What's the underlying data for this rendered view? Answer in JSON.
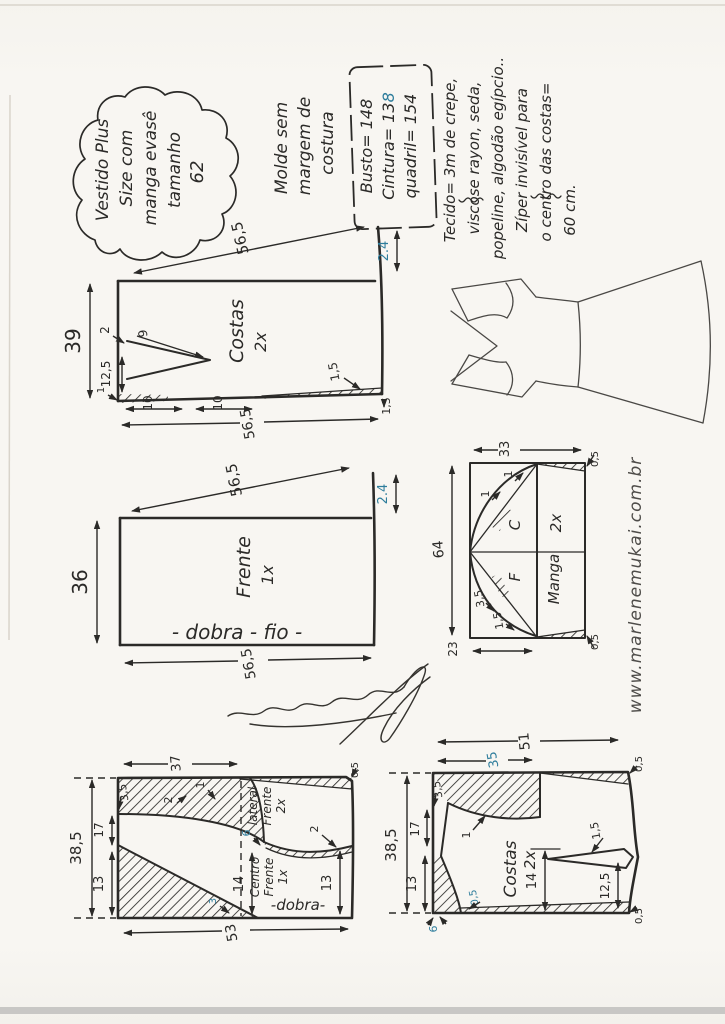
{
  "colors": {
    "ink": "#2b2a28",
    "blue": "#2e7d9c",
    "paper": "#f8f6f2"
  },
  "title_cloud": {
    "l1": "Vestido Plus",
    "l2": "Size com",
    "l3": "manga evasê",
    "l4": "tamanho",
    "l5": "62"
  },
  "molde_note": {
    "l1": "Molde sem",
    "l2": "margem de",
    "l3": "costura"
  },
  "measures": {
    "busto": "Busto= 148",
    "cintura_a": "Cintura= 13",
    "cintura_b": "8",
    "quadril": "quadril= 154"
  },
  "fabric": {
    "l1": "Tecido= 3m de crepe,",
    "l2": "viscose rayon, seda,",
    "l3": "popeline, algodão egípcio..",
    "l4": "Zíper invisível para",
    "l5": "o centro das costas=",
    "l6": "60 cm."
  },
  "watermark": "www.marlenemukai.com.br",
  "bodice_back": {
    "label": "Costas",
    "qty": "2x",
    "shoulder": "56,5",
    "neck_drop": "2.4",
    "length": "39",
    "dart_intake": "2",
    "dart_len": "9",
    "dart_pos": "12,5",
    "corner": "1",
    "seg1": "10",
    "seg2": "10",
    "hem": "56,5",
    "hem_curve": "1,5",
    "hem_corner": "1,5"
  },
  "bodice_front": {
    "label": "Frente",
    "qty": "1x",
    "shoulder": "56,5",
    "neck_drop": "2.4",
    "length": "36",
    "fold": "- dobra - fio -",
    "hem": "56,5"
  },
  "sleeve": {
    "label": "Manga",
    "qty": "2x",
    "top": "33",
    "width": "64",
    "bottom": "23",
    "back_letter": "C",
    "front_letter": "F",
    "n1": "1",
    "n2": "1",
    "n3": "3,5",
    "n4": "1,5",
    "c_top": "0,5",
    "c_bottom": "0,5"
  },
  "skirt_front": {
    "side1": "lateral",
    "side2": "Frente",
    "side3": "2x",
    "center1": "Centro",
    "center2": "Frente",
    "center3": "1x",
    "fold": "-dobra-",
    "top": "37",
    "length": "38,5",
    "s1": "3,5",
    "s2": "17",
    "s3": "13",
    "mid": "14",
    "hem": "53",
    "right": "13",
    "n_waist1": "1",
    "n_waist2": "2",
    "n_blue6": "6",
    "n_hip": "2",
    "n_blue3": "3",
    "c_tr": "0,5"
  },
  "skirt_back": {
    "label": "Costas",
    "qty": "2x",
    "top": "51",
    "yoke": "35",
    "length": "38,5",
    "s1": "3,5",
    "s2": "17",
    "s3": "13",
    "mid": "14",
    "dart": "1,5",
    "right": "12,5",
    "waist": "1",
    "c_tr": "0,5",
    "c_br": "0,5",
    "n_blue05": "0,5",
    "n_blue6": "6"
  }
}
